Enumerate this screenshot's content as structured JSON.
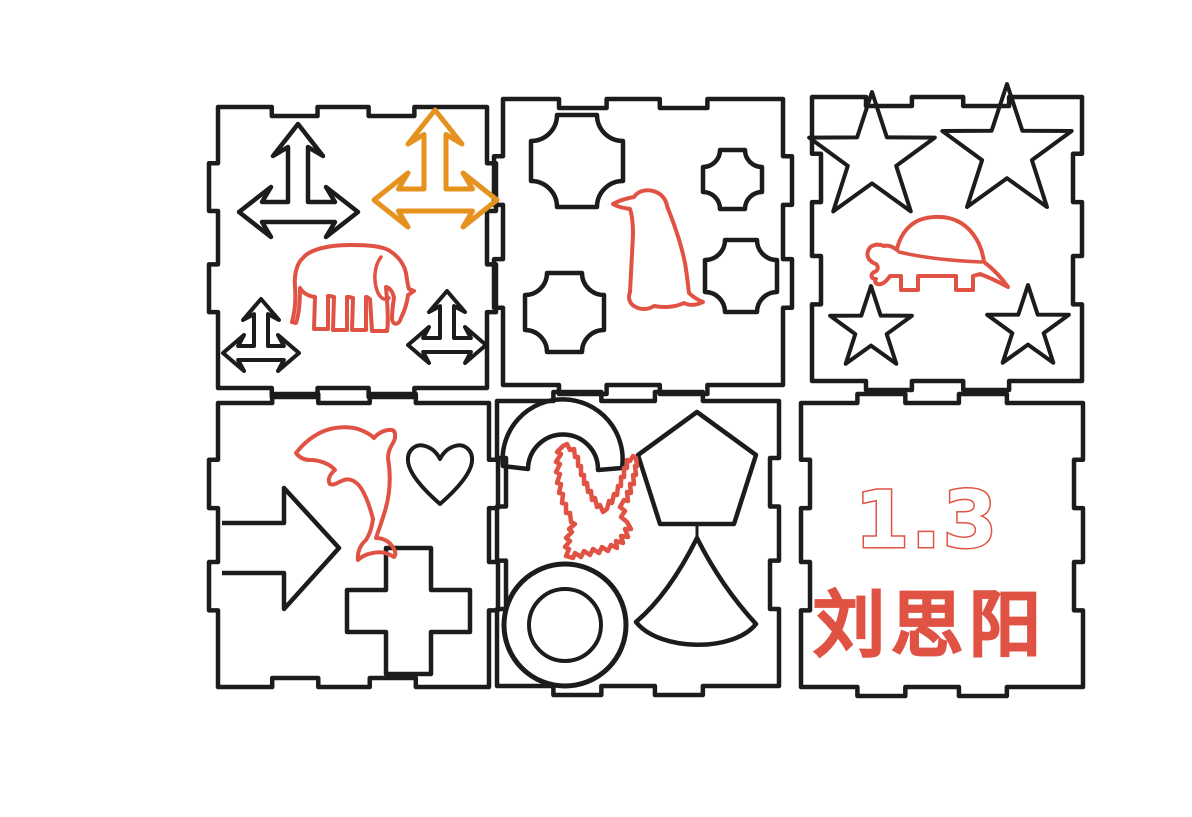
{
  "design": {
    "description": "Laser-cut puzzle box panel layout with engraved shapes",
    "colors": {
      "background": "#ffffff",
      "cut_line": "#1c1c1c",
      "engrave_line": "#e05243",
      "highlight_line": "#e5921f"
    },
    "engraved_text": {
      "number": "1.3",
      "name": "刘思阳"
    },
    "panels": [
      {
        "id": "top-left",
        "engraving": "elephant",
        "cut_shapes": [
          "three-way-arrow-large-black",
          "three-way-arrow-large-orange",
          "three-way-arrow-small-left",
          "three-way-arrow-small-right"
        ]
      },
      {
        "id": "top-middle",
        "engraving": "penguin",
        "cut_shapes": [
          "concave-square-large",
          "concave-square-small",
          "concave-square-medium-right",
          "concave-square-medium-left"
        ]
      },
      {
        "id": "top-right",
        "engraving": "turtle",
        "cut_shapes": [
          "star-large-left",
          "star-large-right",
          "star-small-left",
          "star-small-right"
        ]
      },
      {
        "id": "bottom-left",
        "engraving": "dolphin",
        "cut_shapes": [
          "heart",
          "right-arrow",
          "plus-cross"
        ]
      },
      {
        "id": "bottom-middle",
        "engraving": "eagle",
        "cut_shapes": [
          "arch",
          "pentagon",
          "bell-cone",
          "ring"
        ]
      },
      {
        "id": "bottom-right",
        "engraving": "text-label",
        "cut_shapes": []
      }
    ]
  }
}
